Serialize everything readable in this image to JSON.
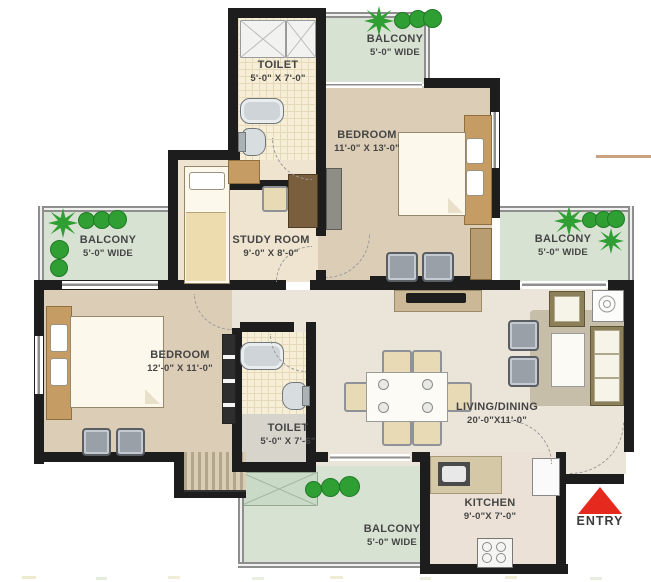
{
  "plan_title": "2BHK + Study Floor Plan",
  "rooms": {
    "toilet_top": {
      "name": "TOILET",
      "dims": "5'-0\" X 7'-0\""
    },
    "balcony_top": {
      "name": "BALCONY",
      "dims": "5'-0\" WIDE"
    },
    "bedroom_top": {
      "name": "BEDROOM",
      "dims": "11'-0\" X 13'-0\""
    },
    "balcony_left": {
      "name": "BALCONY",
      "dims": "5'-0\" WIDE"
    },
    "study": {
      "name": "STUDY ROOM",
      "dims": "9'-0\" X 8'-0\""
    },
    "balcony_right": {
      "name": "BALCONY",
      "dims": "5'-0\" WIDE"
    },
    "bedroom_left": {
      "name": "BEDROOM",
      "dims": "12'-0\" X 11'-0\""
    },
    "toilet_bottom": {
      "name": "TOILET",
      "dims": "5'-0\" X 7'-6\""
    },
    "living": {
      "name": "LIVING/DINING",
      "dims": "20'-0\"X11'-0\""
    },
    "balcony_bottom": {
      "name": "BALCONY",
      "dims": "5'-0\" WIDE"
    },
    "kitchen": {
      "name": "KITCHEN",
      "dims": "9'-0\"X 7'-0\""
    }
  },
  "entry": {
    "label": "ENTRY",
    "arrow_color": "#e6291f"
  },
  "colors": {
    "wall": "#1d1d1d",
    "balcony_floor": "#d8e2d3",
    "bedroom_floor": "#dccdb7",
    "living_floor": "#ebe5d9",
    "tile_floor": "#f7eed8",
    "plant_green": "#2f9e33",
    "entry_arrow_red": "#e6291f"
  }
}
